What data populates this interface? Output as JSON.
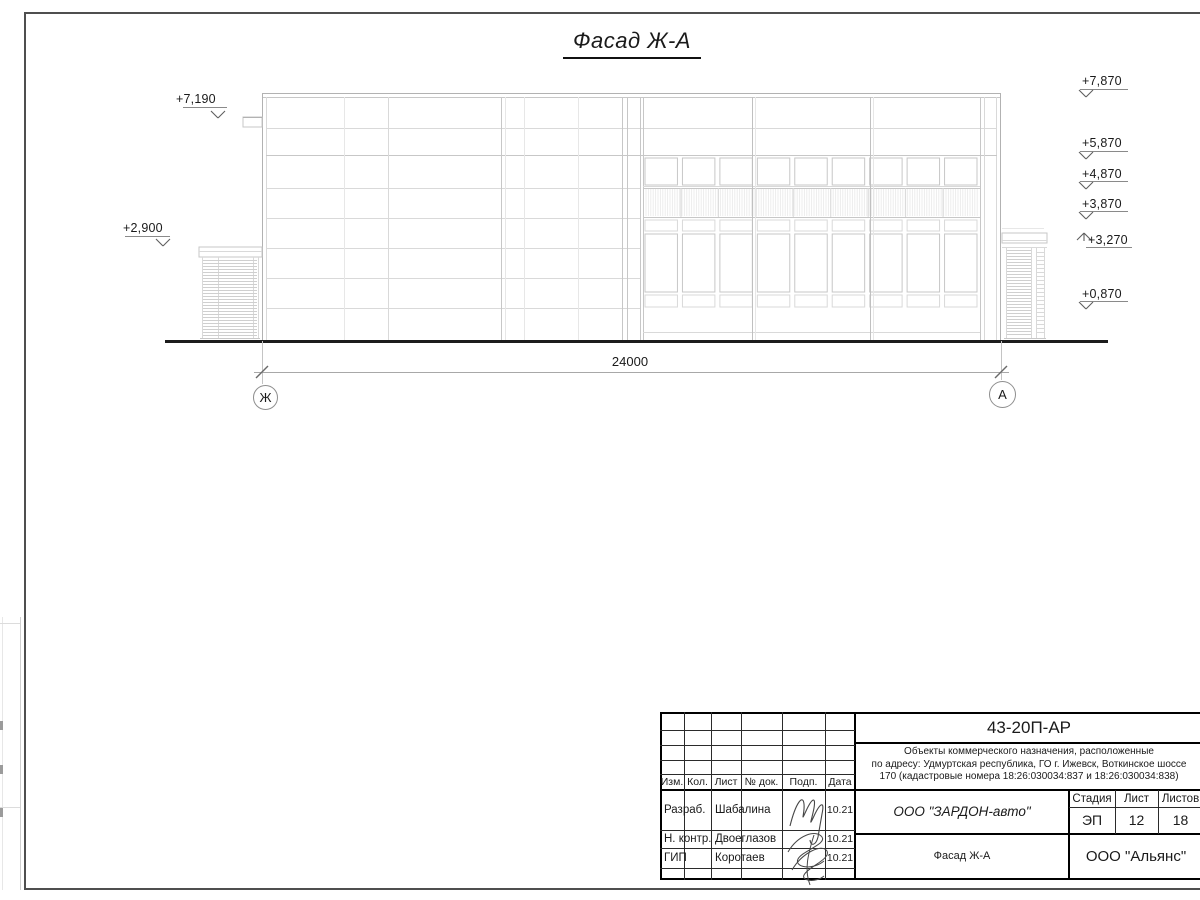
{
  "drawing": {
    "title": "Фасад Ж-А",
    "dimension": "24000",
    "axis_left": "Ж",
    "axis_right": "А",
    "elevations_left": [
      {
        "label": "+7,190"
      },
      {
        "label": "+2,900"
      }
    ],
    "elevations_right": [
      {
        "label": "+7,870"
      },
      {
        "label": "+5,870"
      },
      {
        "label": "+4,870"
      },
      {
        "label": "+3,870"
      },
      {
        "label": "+3,270"
      },
      {
        "label": "+0,870"
      }
    ]
  },
  "title_block": {
    "doc_code": "43-20П-АР",
    "project_line1": "Объекты коммерческого назначения, расположенные",
    "project_line2": "по адресу: Удмуртская республика, ГО г. Ижевск, Воткинское шоссе",
    "project_line3": "170 (кадастровые номера 18:26:030034:837 и 18:26:030034:838)",
    "columns": [
      "Изм.",
      "Кол.",
      "Лист",
      "№ док.",
      "Подп.",
      "Дата"
    ],
    "rows": [
      {
        "role": "Разраб.",
        "name": "Шабалина",
        "date": "10.21"
      },
      {
        "role": "Н. контр.",
        "name": "Двоеглазов",
        "date": "10.21"
      },
      {
        "role": "ГИП",
        "name": "Коротаев",
        "date": "10.21"
      }
    ],
    "company": "ООО \"ЗАРДОН-авто\"",
    "stage_label": "Стадия",
    "sheet_label": "Лист",
    "sheets_label": "Листов",
    "stage": "ЭП",
    "sheet": "12",
    "sheets": "18",
    "sheet_title": "Фасад Ж-А",
    "firm": "ООО \"Альянс\""
  }
}
